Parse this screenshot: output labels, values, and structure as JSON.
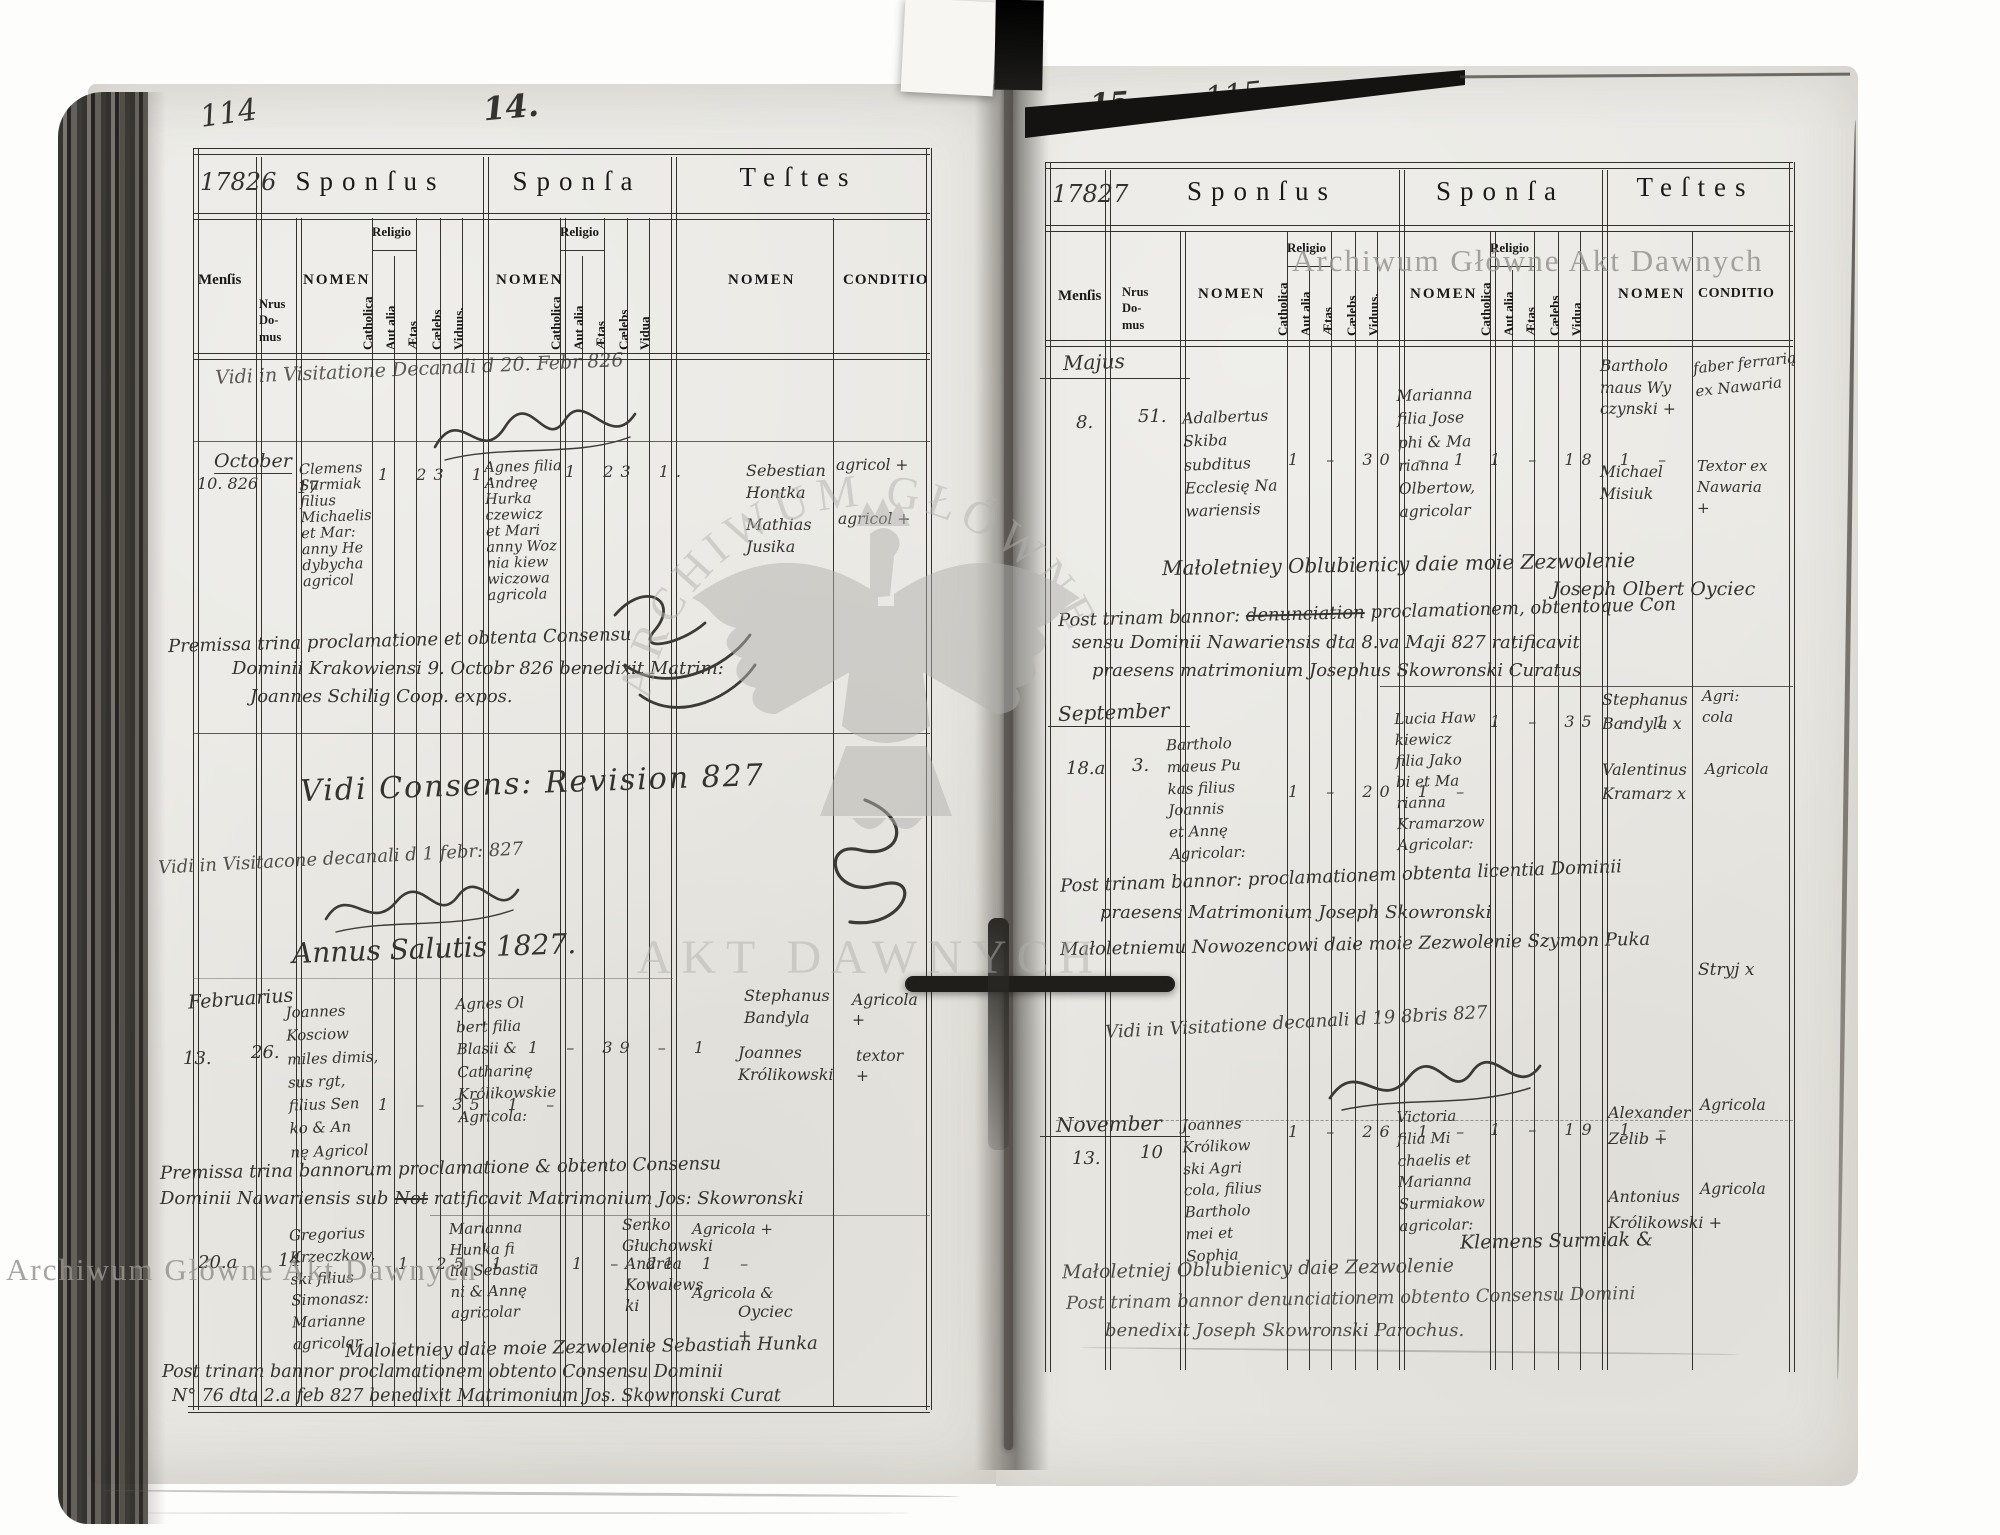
{
  "book": {
    "left_folio": "114",
    "left_page_no": "14.",
    "left_year": "17826",
    "right_folio": "115",
    "right_page_no": "15.",
    "right_year": "17827"
  },
  "headers": {
    "sponsus": "Sponſus",
    "sponsa": "Sponſa",
    "testes": "Teſtes",
    "mensis": "Menſis",
    "nrus": "Nrus\nDo-\nmus",
    "nomen": "NOMEN",
    "religio": "Religio",
    "catholica": "Catholica",
    "aut_alia": "Aut alia",
    "aetas": "Ætas",
    "caelebs": "Cælebs",
    "viduus": "Viduus.",
    "vidua": "Vidua",
    "conditio": "CONDITIO"
  },
  "left": {
    "top_note": "Vidi in Visitatione Decanali d 20. Febr 826",
    "revision_note": "Vidi Consens: Revision 827",
    "visit_note": "Vidi in Visitacone decanali d 1 febr: 827",
    "annus": "Annus Salutis 1827.",
    "october": {
      "month": "October",
      "date": "10. 826",
      "house": "17",
      "sponsus": "Clemens\nSurmiak\nfilius\nMichaelis\net Mar:\nanny He\ndybycha\nagricol",
      "sponsus_marks": "1  23  1.",
      "sponsa": "Agnes filia\nAndreę\nHurka\nczewicz\net Mari\nanny Woz\nnia kiew\nwiczowa\nagricola",
      "sponsa_marks": "1  23  1.",
      "testis1": "Sebestian\nHontka",
      "testis1_cond": "agricol +",
      "testis2": "Mathias\nJusika",
      "testis2_cond": "agricol +",
      "note1": "Premissa trina proclamatione et obtenta Consensu",
      "note2": "Dominii Krakowiensi 9. Octobr 826 benedixit Matrim:",
      "note3": "Joannes Schilig Coop. expos."
    },
    "february": {
      "month": "Februarius",
      "date": "13.",
      "house": "26.",
      "sponsus": "Joannes\nKosciow\nmiles dimis,\nsus rgt,\nfilius Sen\nko & An\nnę Agricol",
      "sponsus_marks": "1 – 35 1 –",
      "sponsa": "Agnes Ol\nbert filia\nBlasii &\nCatharinę\nKrólikowskie\nAgricola:",
      "sponsa_marks": "1 – 39 – 1",
      "testis1": "Stephanus\nBandyla",
      "testis1_cond": "Agricola\n+",
      "testis2": "Joannes\nKrólikowski",
      "testis2_cond": "textor\n+",
      "note1": "Premissa trina bannorum proclamatione & obtento Consensu",
      "note2a": "Dominii Nawariensis sub",
      "note2_struck": "Not",
      "note2b": "ratificavit Matrimonium Jos: Skowronski"
    },
    "r20": {
      "date": "20.a",
      "house": "14",
      "sponsus": "Gregorius\nKrzeczkow,\nski filius\nSimonasz:\nMarianne\nagricolar",
      "sponsus_marks": "1  25 1 –",
      "sponsa": "Marianna\nHunka fi\nlia Sebastia\nni & Annę\nagricolar",
      "sponsa_marks": "1 – 21 1 –",
      "testis1": "Senko\nGłuchowski",
      "testis1_cond": "Agricola +",
      "testis2": "Andrea\nKowalews\nki",
      "testis2_cond": "Agricola &",
      "permission": "Maloletniey daie moie Zezwolenie Sebastian Hunka",
      "permission2": "Oyciec\n+",
      "note1": "Post trinam bannor proclamationem obtento Consensu Dominii",
      "note2": "N° 76 dta 2.a feb 827 benedixit Matrimonium Jos. Skowronski Curat"
    }
  },
  "right": {
    "visit_note": "Vidi in Visitatione decanali d 19 8bris 827",
    "may": {
      "month": "Majus",
      "date": "8.",
      "house": "51.",
      "sponsus": "Adalbertus\nSkiba\nsubditus\nEcclesię Na\nwariensis",
      "sponsus_marks": "1 – 30 – 1",
      "sponsa": "Marianna\nfilia Jose\nphi & Ma\nrianna\nOlbertow,\nagricolar",
      "sponsa_marks": "1 – 18 1 –",
      "testis1": "Bartholo\nmaus Wy\nczynski +",
      "testis1_cond": "faber ferrarią\nex Nawaria",
      "testis2": "Michael\nMisiuk",
      "testis2_cond": "Textor ex\nNawaria\n+",
      "permission": "Małoletniey Oblubienicy daie moie Zezwolenie",
      "permission2": "Joseph Olbert Oyciec",
      "note1a": "Post trinam bannor:",
      "note1_struck": "denunciation",
      "note1b": "proclamationem, obtentoque Con",
      "note2": "sensu Dominii Nawariensis dta 8.va Maji 827 ratificavit",
      "note3": "praesens matrimonium Josephus Skowronski Curatus"
    },
    "september": {
      "month": "September",
      "date": "18.a",
      "house": "3.",
      "sponsus": "Bartholo\nmaeus Pu\nkas filius\nJoannis\net Annę\nAgricolar:",
      "sponsus_marks": "1 – 20 1 –",
      "sponsa": "Lucia Haw\nkiewicz\nfilia Jako\nbi et Ma\nrianna\nKramarzow\nAgricolar:",
      "sponsa_marks": "1 – 35 – 1",
      "testis1": "Stephanus\nBandyla x",
      "testis1_cond": "Agri:\ncola",
      "testis2": "Valentinus\nKramarz x",
      "testis2_cond": "Agricola",
      "note1": "Post trinam bannor: proclamationem obtenta licentia Dominii",
      "note2": "praesens Matrimonium Joseph Skowronski",
      "note3": "Małoletniemu Nowozencowi daie moie Zezwolenie Szymon Puka",
      "note4": "Stryj x"
    },
    "november": {
      "month": "November",
      "date": "13.",
      "house": "10",
      "sponsus": "Joannes\nKrólikow\nski Agri\ncola, filius\nBartholo\nmei et\nSophia",
      "sponsus_marks": "1 – 26 1 –",
      "sponsa": "Victoria\nfilia Mi\nchaelis et\nMarianna\nSurmiakow\nagricolar:",
      "sponsa_marks": "1 – 19 1 –",
      "testis1": "Alexander\nZelib +",
      "testis1_cond": "Agricola",
      "testis2": "Antonius\nKrólikowski +",
      "testis2_cond": "Agricola",
      "permission_r": "Klemens Surmiak &",
      "permission": "Małoletniej Oblubienicy daie Zezwolenie",
      "note1": "Post trinam bannor denunciationem obtento Consensu Domini",
      "note2": "benedixit Joseph Skowronski Parochus."
    }
  },
  "watermarks": {
    "top_right": "Archiwum Główne Akt Dawnych",
    "bottom_left": "Archiwum Główne Akt Dawnych",
    "stamp_top": "ARCHIWUM GŁÓWNE",
    "stamp_bottom": "AKT DAWNYCH"
  }
}
